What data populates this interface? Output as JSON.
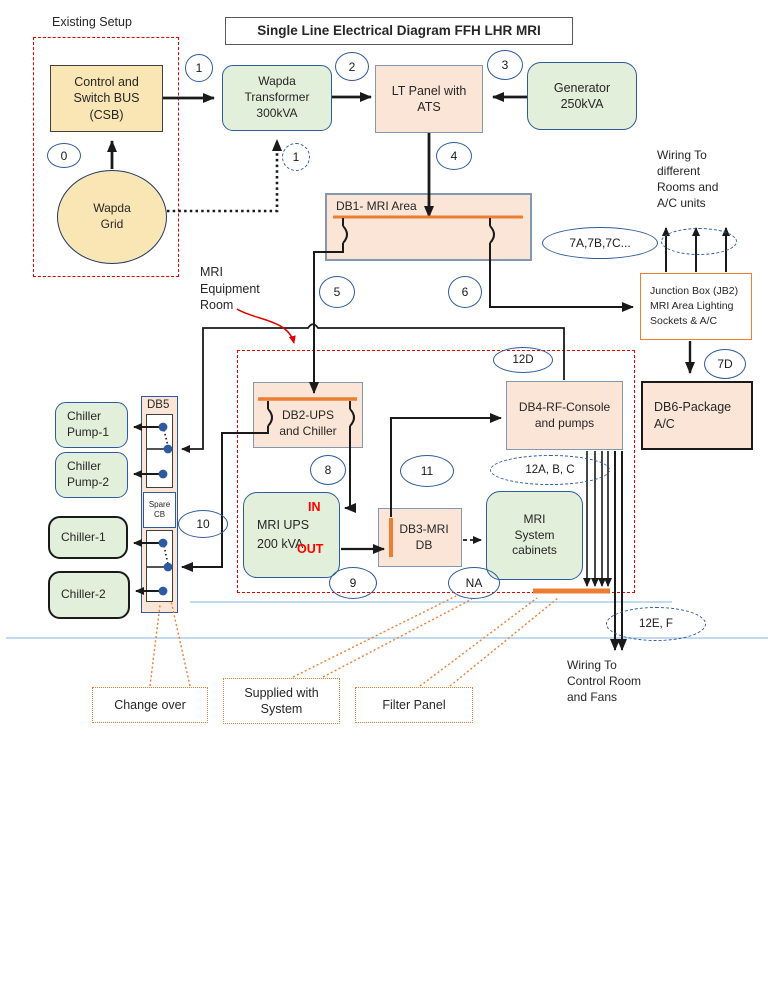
{
  "title": "Single Line Electrical Diagram FFH LHR MRI",
  "existing_setup_label": "Existing Setup",
  "mri_room_label": [
    "MRI",
    "Equipment",
    "Room"
  ],
  "nodes": {
    "csb": [
      "Control and",
      "Switch BUS",
      "(CSB)"
    ],
    "grid": [
      "Wapda",
      "Grid"
    ],
    "transformer": [
      "Wapda",
      "Transformer",
      "300kVA"
    ],
    "lt_panel": [
      "LT Panel with",
      "ATS"
    ],
    "generator": [
      "Generator",
      "250kVA"
    ],
    "db1": "DB1- MRI Area",
    "jb2": [
      "Junction Box (JB2)",
      "MRI Area Lighting",
      "Sockets & A/C"
    ],
    "wiring_rooms": [
      "Wiring To",
      "different",
      "Rooms and",
      "A/C units"
    ],
    "db6": [
      "DB6-Package",
      "A/C"
    ],
    "db4": [
      "DB4-RF-Console",
      "and pumps"
    ],
    "db2": [
      "DB2-UPS",
      "and Chiller"
    ],
    "db5": "DB5",
    "spare_cb": [
      "Spare",
      "CB"
    ],
    "chiller_pump1": [
      "Chiller",
      "Pump-1"
    ],
    "chiller_pump2": [
      "Chiller",
      "Pump-2"
    ],
    "chiller1": "Chiller-1",
    "chiller2": "Chiller-2",
    "ups": [
      "MRI UPS",
      "200 kVA"
    ],
    "ups_in": "IN",
    "ups_out": "OUT",
    "db3": [
      "DB3-MRI",
      "DB"
    ],
    "cabinets": [
      "MRI",
      "System",
      "cabinets"
    ],
    "wiring_control": [
      "Wiring To",
      "Control Room",
      "and Fans"
    ]
  },
  "badges": {
    "b0": "0",
    "b1": "1",
    "b1d": "1",
    "b2": "2",
    "b3": "3",
    "b4": "4",
    "b5": "5",
    "b6": "6",
    "b7abc": "7A,7B,7C...",
    "b7d": "7D",
    "b8": "8",
    "b9": "9",
    "b10": "10",
    "b11": "11",
    "bna": "NA",
    "b12d": "12D",
    "b12abc": "12A, B, C",
    "b12ef": "12E, F"
  },
  "callouts": {
    "change_over": "Change over",
    "supplied": [
      "Supplied with",
      "System"
    ],
    "filter": "Filter Panel"
  },
  "colors": {
    "box_peach": "#FBE5D6",
    "box_green": "#E2EFDA",
    "box_tan": "#FAE6B4",
    "busbar_orange": "#ED7D31",
    "boundary_red": "#E30000",
    "badge_navy": "#2E5B9F",
    "thin_blue_line": "#9DC3E6",
    "in_out_red": "#FF0000"
  }
}
